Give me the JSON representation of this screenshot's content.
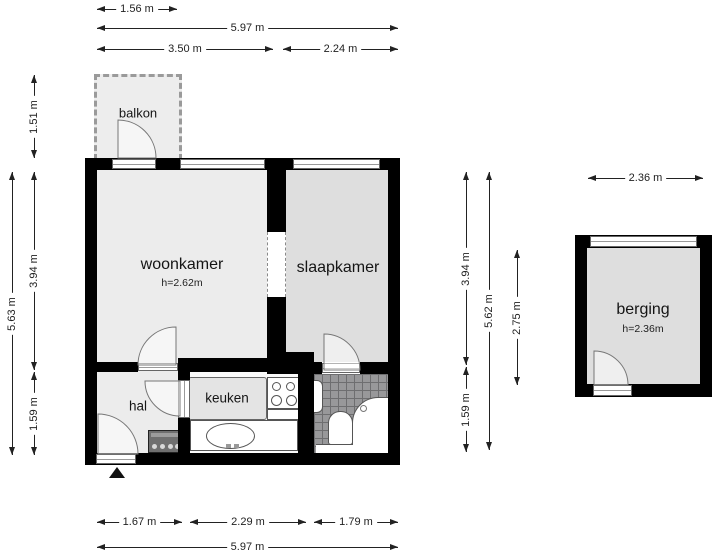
{
  "rooms": {
    "balkon": {
      "label": "balkon"
    },
    "woonkamer": {
      "label": "woonkamer",
      "ceiling_height": "h=2.62m"
    },
    "slaapkamer": {
      "label": "slaapkamer"
    },
    "keuken": {
      "label": "keuken"
    },
    "hal": {
      "label": "hal"
    },
    "berging": {
      "label": "berging",
      "ceiling_height": "h=2.36m"
    }
  },
  "dimensions": {
    "top": [
      {
        "label": "1.56 m"
      },
      {
        "label": "5.97 m"
      },
      {
        "label": "3.50 m"
      },
      {
        "label": "2.24 m"
      }
    ],
    "bottom": [
      {
        "label": "1.67 m"
      },
      {
        "label": "2.29 m"
      },
      {
        "label": "1.79 m"
      },
      {
        "label": "5.97 m"
      }
    ],
    "left": [
      {
        "label": "5.63 m"
      },
      {
        "label": "1.51 m"
      },
      {
        "label": "3.94 m"
      },
      {
        "label": "1.59 m"
      }
    ],
    "right": [
      {
        "label": "3.94 m"
      },
      {
        "label": "1.59 m"
      },
      {
        "label": "5.62 m"
      },
      {
        "label": "2.75 m"
      }
    ],
    "berging": [
      {
        "label": "2.36 m"
      }
    ]
  },
  "symbols": {
    "entrance_marker": "entrance-arrow"
  },
  "colors": {
    "wall": "#000000",
    "floor_light": "#ececec",
    "floor_medium": "#dedede",
    "tile": "#98989a",
    "dimension_text": "#222222"
  }
}
